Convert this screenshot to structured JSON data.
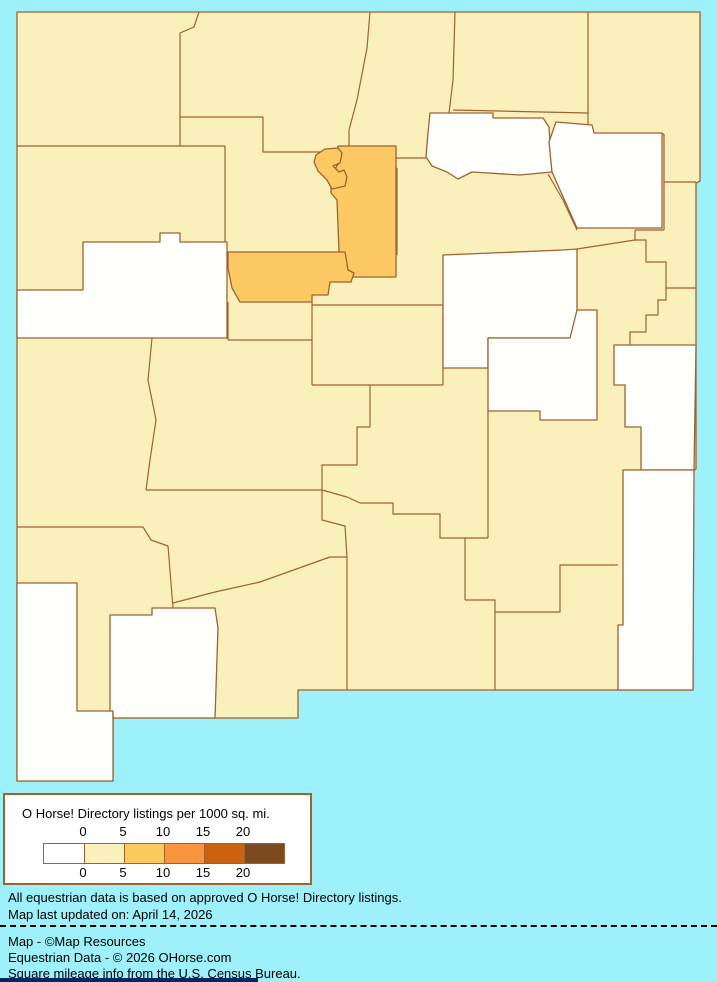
{
  "page": {
    "background_color": "#9EF0FA",
    "bottom_strip_color": "#032566"
  },
  "map": {
    "name": "New Mexico counties choropleth",
    "border_color": "#9E6231",
    "class_colors": {
      "c0": "#FEFEFA",
      "c1": "#FAF0BB",
      "c2": "#FDC963"
    },
    "regions": [
      {
        "name": "san-juan",
        "density": "0-5",
        "class": "c1"
      },
      {
        "name": "rio-arriba",
        "density": "0-5",
        "class": "c1"
      },
      {
        "name": "taos",
        "density": "0-5",
        "class": "c1"
      },
      {
        "name": "colfax",
        "density": "0-5",
        "class": "c1"
      },
      {
        "name": "union",
        "density": "0-5",
        "class": "c1"
      },
      {
        "name": "mckinley",
        "density": "0-5",
        "class": "c1"
      },
      {
        "name": "sandoval",
        "density": "0-5",
        "class": "c1"
      },
      {
        "name": "los-alamos",
        "density": "5-10",
        "class": "c2"
      },
      {
        "name": "santa-fe",
        "density": "5-10",
        "class": "c2"
      },
      {
        "name": "mora",
        "density": "0",
        "class": "c0"
      },
      {
        "name": "harding",
        "density": "0",
        "class": "c0"
      },
      {
        "name": "san-miguel",
        "density": "0-5",
        "class": "c1"
      },
      {
        "name": "quay",
        "density": "0-5",
        "class": "c1"
      },
      {
        "name": "curry",
        "density": "0-5",
        "class": "c1"
      },
      {
        "name": "cibola",
        "density": "0",
        "class": "c0"
      },
      {
        "name": "valencia",
        "density": "0-5",
        "class": "c1"
      },
      {
        "name": "bernalillo",
        "density": "5-10",
        "class": "c2"
      },
      {
        "name": "torrance",
        "density": "0-5",
        "class": "c1"
      },
      {
        "name": "guadalupe",
        "density": "0",
        "class": "c0"
      },
      {
        "name": "de-baca",
        "density": "0",
        "class": "c0"
      },
      {
        "name": "roosevelt",
        "density": "0",
        "class": "c0"
      },
      {
        "name": "catron",
        "density": "0-5",
        "class": "c1"
      },
      {
        "name": "socorro",
        "density": "0-5",
        "class": "c1"
      },
      {
        "name": "lincoln",
        "density": "0-5",
        "class": "c1"
      },
      {
        "name": "chaves",
        "density": "0-5",
        "class": "c1"
      },
      {
        "name": "sierra",
        "density": "0-5",
        "class": "c1"
      },
      {
        "name": "grant",
        "density": "0-5",
        "class": "c1"
      },
      {
        "name": "hidalgo",
        "density": "0",
        "class": "c0"
      },
      {
        "name": "luna",
        "density": "0",
        "class": "c0"
      },
      {
        "name": "dona-ana",
        "density": "0-5",
        "class": "c1"
      },
      {
        "name": "otero",
        "density": "0-5",
        "class": "c1"
      },
      {
        "name": "eddy",
        "density": "0-5",
        "class": "c1"
      },
      {
        "name": "lea",
        "density": "0",
        "class": "c0"
      }
    ]
  },
  "legend": {
    "title": "O Horse! Directory listings per 1000 sq. mi.",
    "tick_labels": [
      "0",
      "5",
      "10",
      "15",
      "20"
    ],
    "swatch_colors": [
      "#FFFFFF",
      "#FAF0BB",
      "#FCC95F",
      "#F9953F",
      "#CB6211",
      "#7C4A1E"
    ],
    "border_color": "#9E6231"
  },
  "notes": {
    "line1": "All equestrian data is based on approved O Horse! Directory listings.",
    "line2": "Map last updated on: April 14, 2026"
  },
  "credits": {
    "line1": "Map - ©Map Resources",
    "line2": "Equestrian Data - © 2026 OHorse.com",
    "line3": "Square mileage info from the U.S. Census Bureau."
  }
}
